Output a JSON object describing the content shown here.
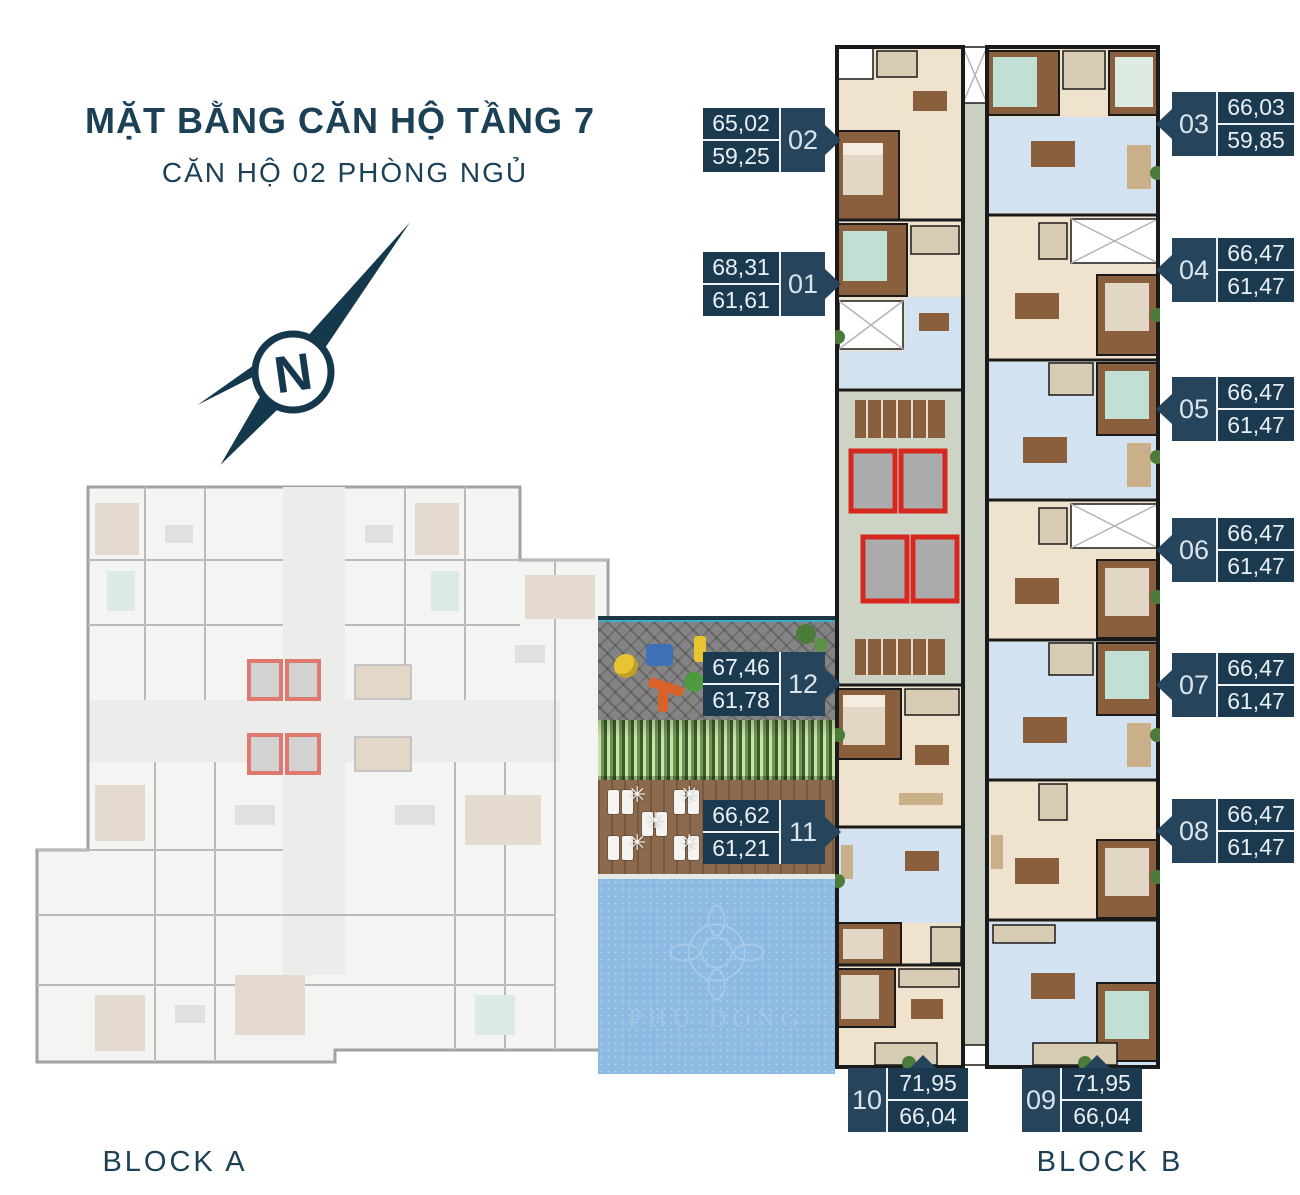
{
  "header": {
    "title": "MẶT BẰNG CĂN HỘ TẦNG 7",
    "subtitle": "CĂN HỘ 02 PHÒNG NGỦ"
  },
  "compass": {
    "letter": "N"
  },
  "blocks": {
    "block_a": "BLOCK A",
    "block_b": "BLOCK B"
  },
  "watermark": {
    "line1": "PHU DONG",
    "line2": "PREMIER"
  },
  "icons": {
    "umbrella": "✳"
  },
  "colors": {
    "brand_navy": "#1C4156",
    "label_bg": "#26455C",
    "label_cell_bg": "#1B3A50",
    "label_text": "#E9EFF4",
    "elevator_red": "#D6281E",
    "pool_blue": "#8CBAE3",
    "deck_brown": "#8C6A4D",
    "hedge_green": "#5E8C46"
  },
  "units": [
    {
      "id": "02",
      "value_top": "65,02",
      "value_bottom": "59,25"
    },
    {
      "id": "01",
      "value_top": "68,31",
      "value_bottom": "61,61"
    },
    {
      "id": "12",
      "value_top": "67,46",
      "value_bottom": "61,78"
    },
    {
      "id": "11",
      "value_top": "66,62",
      "value_bottom": "61,21"
    },
    {
      "id": "03",
      "value_top": "66,03",
      "value_bottom": "59,85"
    },
    {
      "id": "04",
      "value_top": "66,47",
      "value_bottom": "61,47"
    },
    {
      "id": "05",
      "value_top": "66,47",
      "value_bottom": "61,47"
    },
    {
      "id": "06",
      "value_top": "66,47",
      "value_bottom": "61,47"
    },
    {
      "id": "07",
      "value_top": "66,47",
      "value_bottom": "61,47"
    },
    {
      "id": "08",
      "value_top": "66,47",
      "value_bottom": "61,47"
    },
    {
      "id": "10",
      "value_top": "71,95",
      "value_bottom": "66,04"
    },
    {
      "id": "09",
      "value_top": "71,95",
      "value_bottom": "66,04"
    }
  ]
}
